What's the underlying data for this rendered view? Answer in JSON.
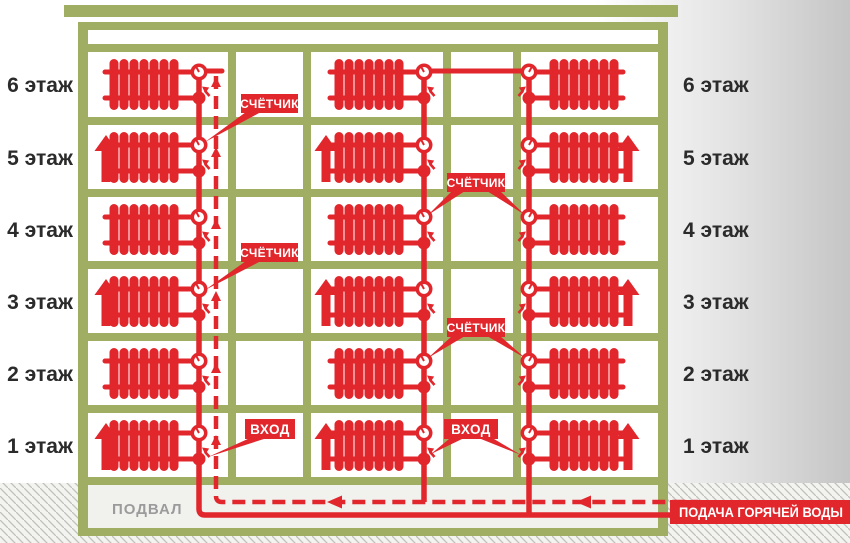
{
  "diagram": {
    "type": "building-heating-scheme",
    "floors_count": 6,
    "radiator_columns": 3
  },
  "labels": {
    "meter": "СЧЁТЧИК",
    "entry": "ВХОД",
    "basement": "ПОДВАЛ",
    "hot_water_supply": "ПОДАЧА ГОРЯЧЕЙ ВОДЫ"
  },
  "floors_left": [
    "6 этаж",
    "5 этаж",
    "4 этаж",
    "3 этаж",
    "2 этаж",
    "1 этаж"
  ],
  "floors_right": [
    "6 этаж",
    "5 этаж",
    "4 этаж",
    "3 этаж",
    "2 этаж",
    "1 этаж"
  ],
  "colors": {
    "structure_green": "#9fae63",
    "pipe_red": "#e1262c",
    "floor_text": "#2b2b2b",
    "basement_text": "#9b9b9b",
    "basement_bg": "#f1f1ee",
    "callout_text": "#ffffff",
    "ground_hatch_line": "#bfbfbc",
    "ground_hatch_bg": "#f3f3f0"
  }
}
